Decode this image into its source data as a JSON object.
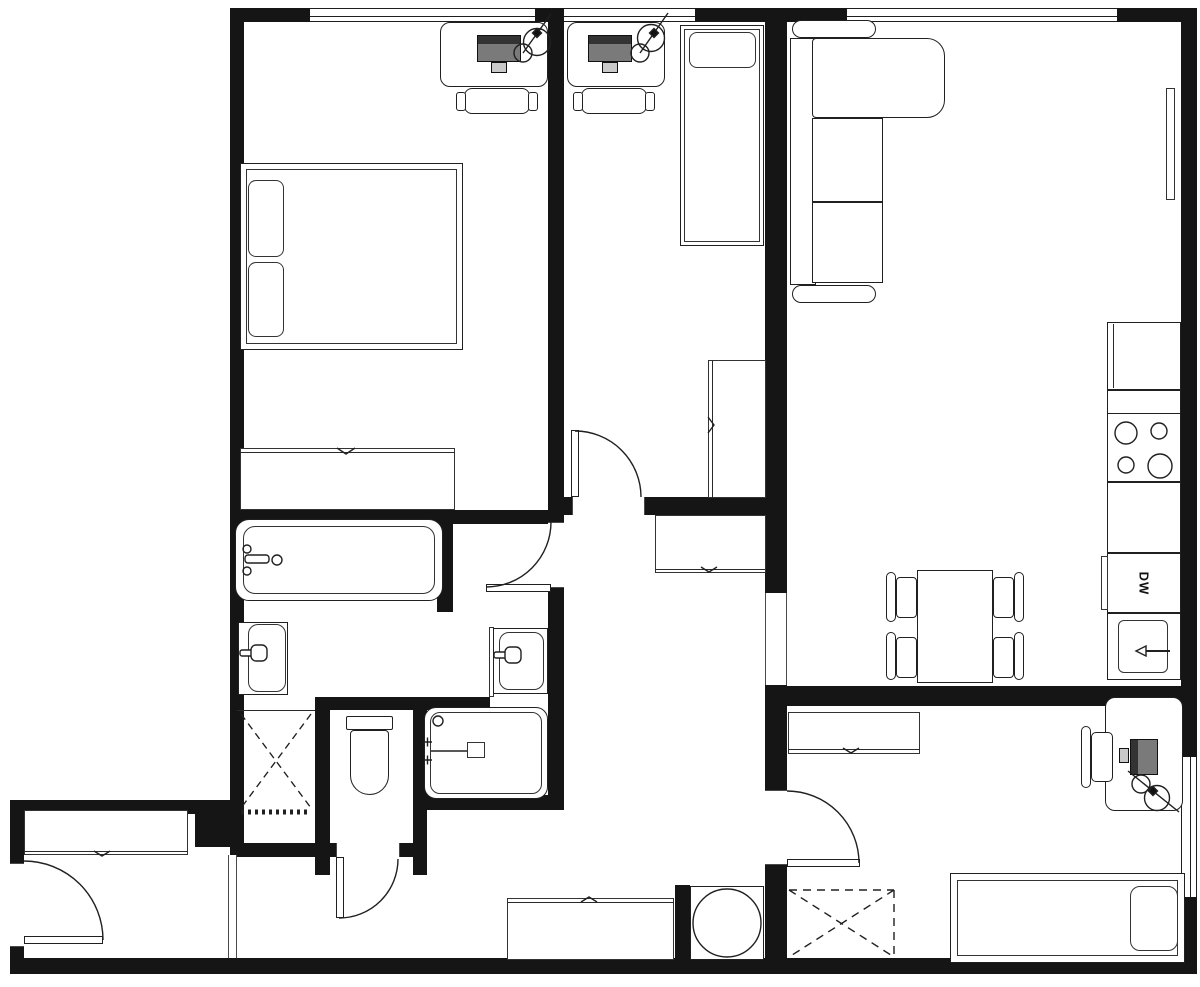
{
  "labels": {
    "dishwasher": "DW"
  },
  "palette": {
    "wall": "#151515",
    "line": "#202020",
    "background": "#ffffff",
    "monitor_body": "#7a7a7a",
    "monitor_screen": "#333333"
  },
  "icons": [
    "double-bed-icon",
    "single-bed-icon",
    "desk-icon",
    "office-chair-icon",
    "desk-lamp-icon",
    "computer-monitor-icon",
    "sofa-sectional-icon",
    "tv-icon",
    "dining-table-icon",
    "dining-chair-icon",
    "fridge-icon",
    "stove-burners-icon",
    "dishwasher-icon",
    "kitchen-sink-icon",
    "bathtub-icon",
    "washbasin-icon",
    "toilet-icon",
    "shower-icon",
    "washing-machine-icon",
    "wardrobe-icon",
    "closet-cross-icon",
    "door-swing-icon",
    "window-icon",
    "sliding-door-mark-icon"
  ]
}
